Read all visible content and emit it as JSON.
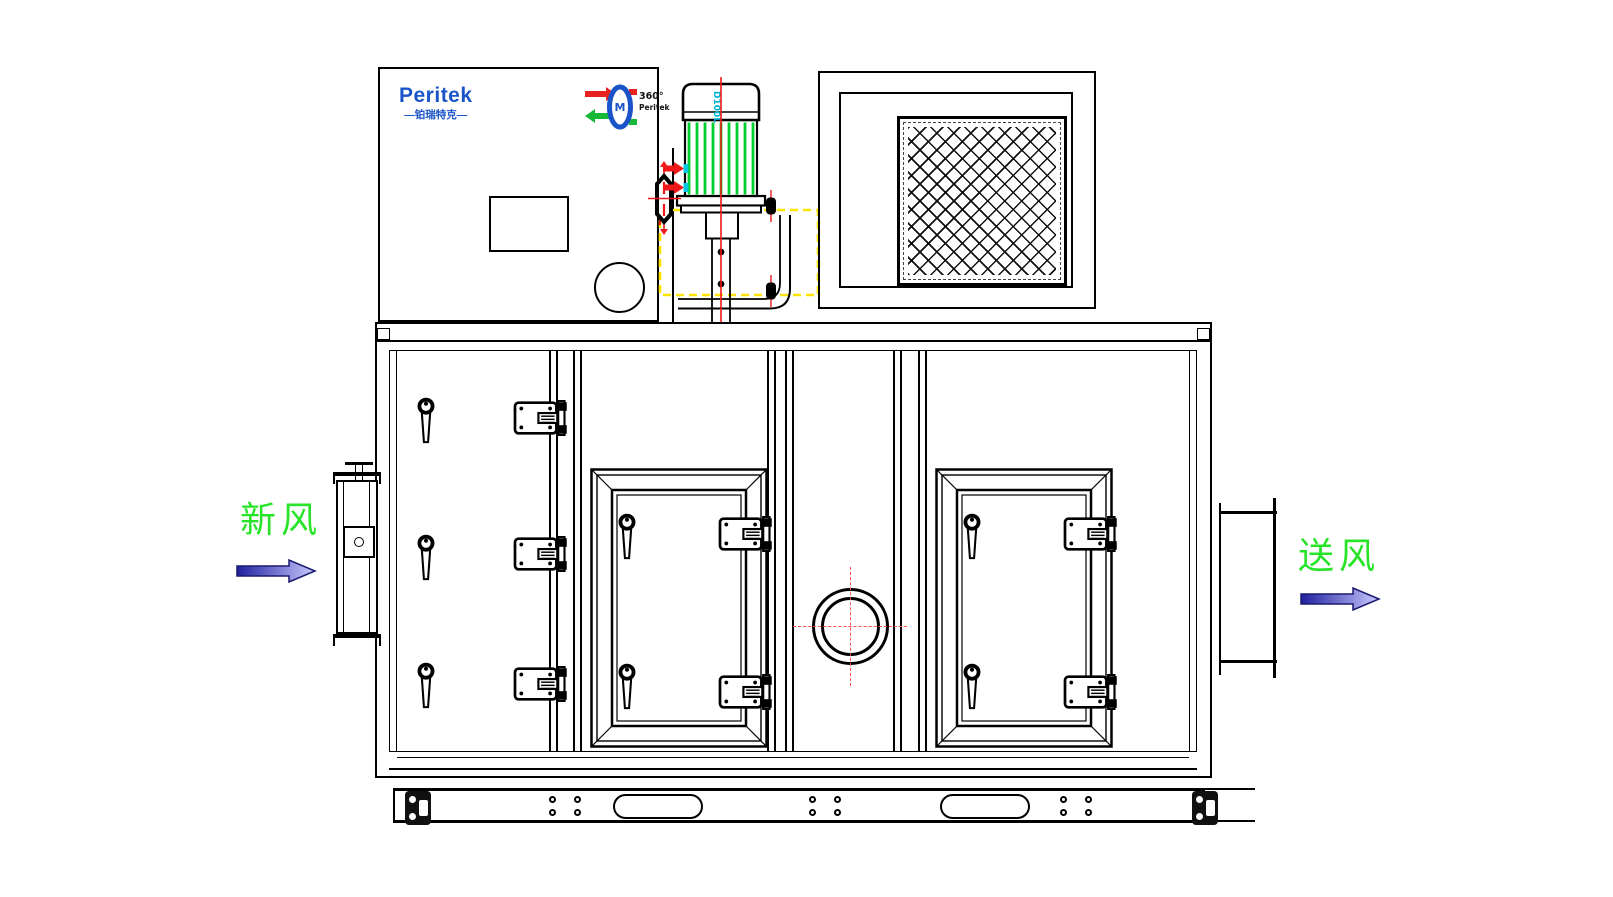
{
  "drawing": {
    "title": "Peritek rotary dehumidifier - front elevation",
    "brand": {
      "name": "Peritek",
      "cn": "—铂瑞特克—"
    },
    "wheel_logo": {
      "degrees": "360°",
      "brand": "Peritek"
    },
    "motor": {
      "model": "D100L"
    },
    "airflow": {
      "inlet": "新风",
      "outlet": "送风"
    },
    "colors": {
      "line_black": "#000000",
      "brand_blue": "#1b54c8",
      "label_green": "#28e428",
      "fin_green": "#00cf30",
      "centerline_red": "#f01818",
      "phantom_yellow": "#ffe400",
      "accent_cyan": "#00c8e0",
      "arrow_dark": "#2020a0",
      "arrow_light": "#c8c8ff"
    }
  }
}
